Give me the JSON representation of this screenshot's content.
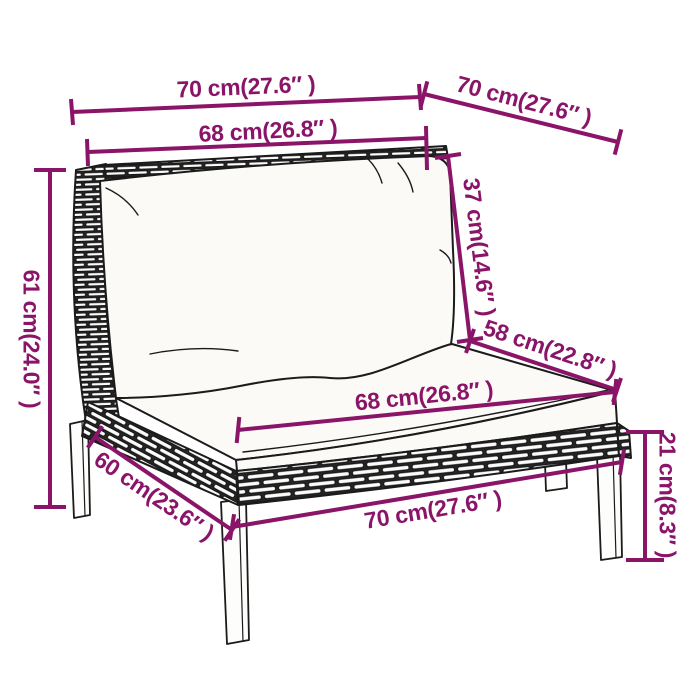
{
  "diagram": {
    "type": "furniture-dimension-diagram",
    "subject": "poly-rattan garden sofa middle section with cushions",
    "background_color": "#ffffff",
    "annotation_color": "#8a1568",
    "outline_color": "#1b1b1b",
    "labels": {
      "top_width": "70 cm(27.6″ )",
      "top_depth": "70 cm(27.6″ )",
      "backrest_width": "68 cm(26.8″ )",
      "backrest_height": "37 cm(14.6″ )",
      "overall_height": "61 cm(24.0″ )",
      "seat_depth": "58 cm(22.8″ )",
      "seat_width": "68 cm(26.8″ )",
      "base_depth": "60 cm(23.6″ )",
      "base_width": "70 cm(27.6″ )",
      "leg_height": "21 cm(8.3″ )"
    }
  }
}
